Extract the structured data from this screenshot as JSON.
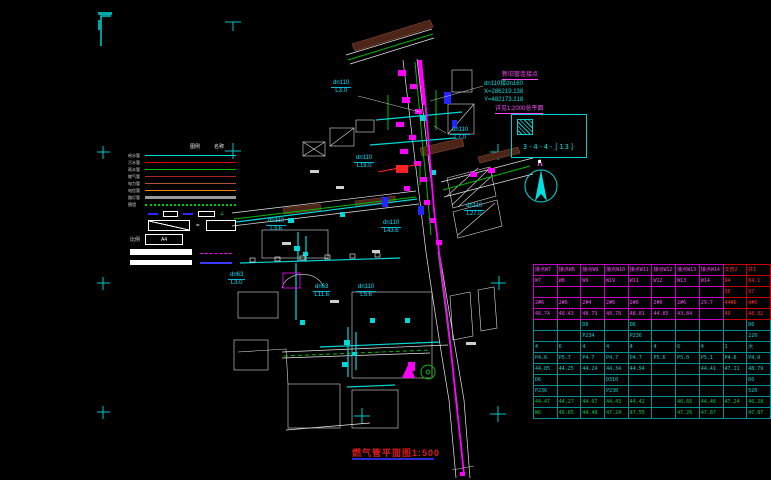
{
  "title": {
    "text": "燃气管平面图1:500"
  },
  "detail": {
    "note": "详见1:2000总平面",
    "ref": "3-4-4-[13]"
  },
  "annotation": {
    "line1": "新旧管连接点",
    "line2": "dn110接dn160",
    "line3": "X=286219.138",
    "line4": "Y=482173.218"
  },
  "pipe_labels": [
    {
      "dia": "dn110",
      "len": "L3.0",
      "x": 331,
      "y": 80
    },
    {
      "dia": "dn110",
      "len": "L7.0",
      "x": 450,
      "y": 127
    },
    {
      "dia": "dn110",
      "len": "L19.0",
      "x": 354,
      "y": 155
    },
    {
      "dia": "dn110",
      "len": "L27.0",
      "x": 464,
      "y": 203
    },
    {
      "dia": "dn110",
      "len": "L43.6",
      "x": 381,
      "y": 220
    },
    {
      "dia": "dn110",
      "len": "L3.6",
      "x": 266,
      "y": 218
    },
    {
      "dia": "dn63",
      "len": "L3.0",
      "x": 228,
      "y": 272
    },
    {
      "dia": "dn63",
      "len": "L11.6",
      "x": 313,
      "y": 284
    },
    {
      "dia": "dn110",
      "len": "L5.6",
      "x": 356,
      "y": 284
    }
  ],
  "legend": {
    "headers": [
      "图例",
      "名称"
    ],
    "items": [
      {
        "label": "给水管",
        "color": "#00dddd",
        "style": "solid"
      },
      {
        "label": "污水管",
        "color": "#dd0000",
        "style": "solid"
      },
      {
        "label": "雨水管",
        "color": "#00bb00",
        "style": "solid"
      },
      {
        "label": "燃气管",
        "color": "#aa2222",
        "style": "solid"
      },
      {
        "label": "电力管",
        "color": "#aa5533",
        "style": "solid"
      },
      {
        "label": "电信管",
        "color": "#ee8800",
        "style": "solid"
      },
      {
        "label": "路灯管",
        "color": "#999999",
        "style": "solid",
        "thick": true
      },
      {
        "label": "围墙",
        "color": "#00cc00",
        "style": "dotted"
      }
    ],
    "eq_sign": "=",
    "scale_label": "比例",
    "a4": "A4",
    "symbol_glyph": "∠"
  },
  "table": {
    "rows": [
      {
        "cls": "m",
        "cells": [
          "接点W7",
          "接点W8",
          "接点W9",
          "接点W10",
          "接点W11",
          "接点W12",
          "接点W13",
          "接点W14",
          "支管2",
          "井1"
        ]
      },
      {
        "cls": "m",
        "cells": [
          "W7",
          "W8",
          "W9",
          "W19",
          "W11",
          "W12",
          "W13",
          "W14",
          "94",
          "84.1"
        ]
      },
      {
        "cls": "m",
        "cells": [
          "",
          "",
          "",
          "",
          "",
          "",
          "",
          "",
          "36",
          "97"
        ]
      },
      {
        "cls": "m",
        "cells": [
          "2#6",
          "2#6",
          "2#4",
          "2#6",
          "2#6",
          "2#6",
          "2#6",
          "29.7",
          "44#6",
          "4#6"
        ]
      },
      {
        "cls": "m",
        "cells": [
          "48.74",
          "48.43",
          "48.73",
          "48.78",
          "48.81",
          "44.85",
          "43.84",
          "",
          "49",
          "48.02"
        ]
      },
      {
        "cls": "c",
        "cells": [
          "",
          "",
          "D6",
          "",
          "D6",
          "",
          "",
          "",
          "",
          "D6"
        ]
      },
      {
        "cls": "c",
        "cells": [
          "",
          "",
          "P234",
          "",
          "P236",
          "",
          "",
          "",
          "",
          "220"
        ]
      },
      {
        "cls": "c",
        "cells": [
          "4",
          "6",
          "4",
          "4",
          "4",
          "4",
          "6",
          "4",
          "1",
          "大"
        ]
      },
      {
        "cls": "c",
        "cells": [
          "P4.6",
          "P5.7",
          "P4.7",
          "P4.7",
          "P4.7",
          "P5.6",
          "P5.0",
          "P5.1",
          "P4.6",
          "P4.0"
        ]
      },
      {
        "cls": "c",
        "cells": [
          "44.85",
          "44.25",
          "44.24",
          "44.34",
          "44.94",
          "",
          "",
          "44.41",
          "47.11",
          "48.79"
        ]
      },
      {
        "cls": "c",
        "cells": [
          "D6",
          "",
          "",
          "D310",
          "",
          "",
          "",
          "",
          "",
          "D6"
        ]
      },
      {
        "cls": "c",
        "cells": [
          "P236",
          "",
          "",
          "P230",
          "",
          "",
          "",
          "",
          "",
          "520"
        ]
      },
      {
        "cls": "g",
        "cells": [
          "44.47",
          "44.27",
          "44.07",
          "44.43",
          "44.42",
          "",
          "46.65",
          "44.48",
          "47.24",
          "46.28"
        ]
      },
      {
        "cls": "g",
        "cells": [
          "W6",
          "46.65",
          "44.48",
          "47.24",
          "47.55",
          "",
          "47.26",
          "47.87",
          "",
          "47.87"
        ]
      }
    ]
  }
}
